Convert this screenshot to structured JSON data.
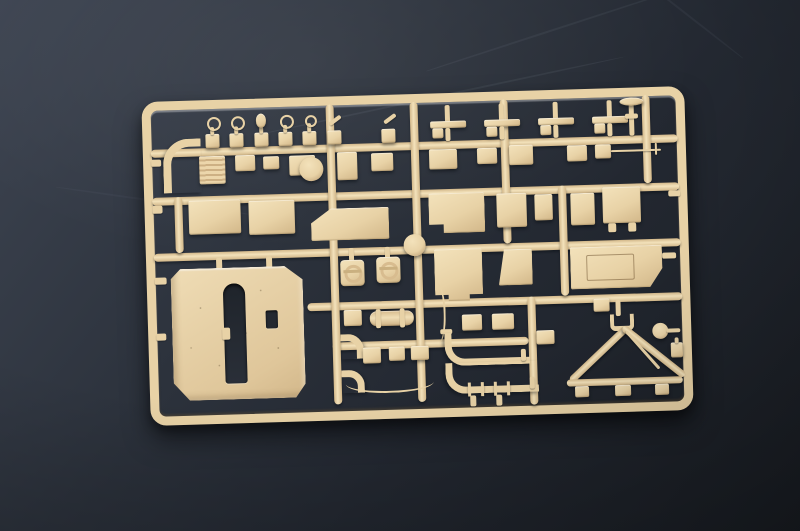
{
  "scene": {
    "description": "Photograph of an injection-molded plastic model kit sprue (parts tree) in sand-tan polystyrene lying at a slight angle on a dark slate-gray surface",
    "object": "model-kit-sprue",
    "plastic_color_name": "sand tan",
    "surface_name": "dark slate",
    "notable_parts": [
      "large-slotted-armor-panel",
      "round-hatch-discs-with-handles",
      "circular-disc-part",
      "a-frame-tow-bar",
      "curved-exhaust-tubes",
      "lifting-eye-knob-row",
      "gun-barrel-segment",
      "mushroom-cap-part",
      "thin-antenna-rod",
      "beveled-engraved-panel"
    ]
  },
  "colors": {
    "bg1": "#3e4552",
    "bg2": "#2c323c",
    "bg3": "#191d23",
    "p1": "#f3e2bb",
    "p2": "#e8d2a6",
    "p3": "#d2b789",
    "p4": "#b3946a"
  }
}
